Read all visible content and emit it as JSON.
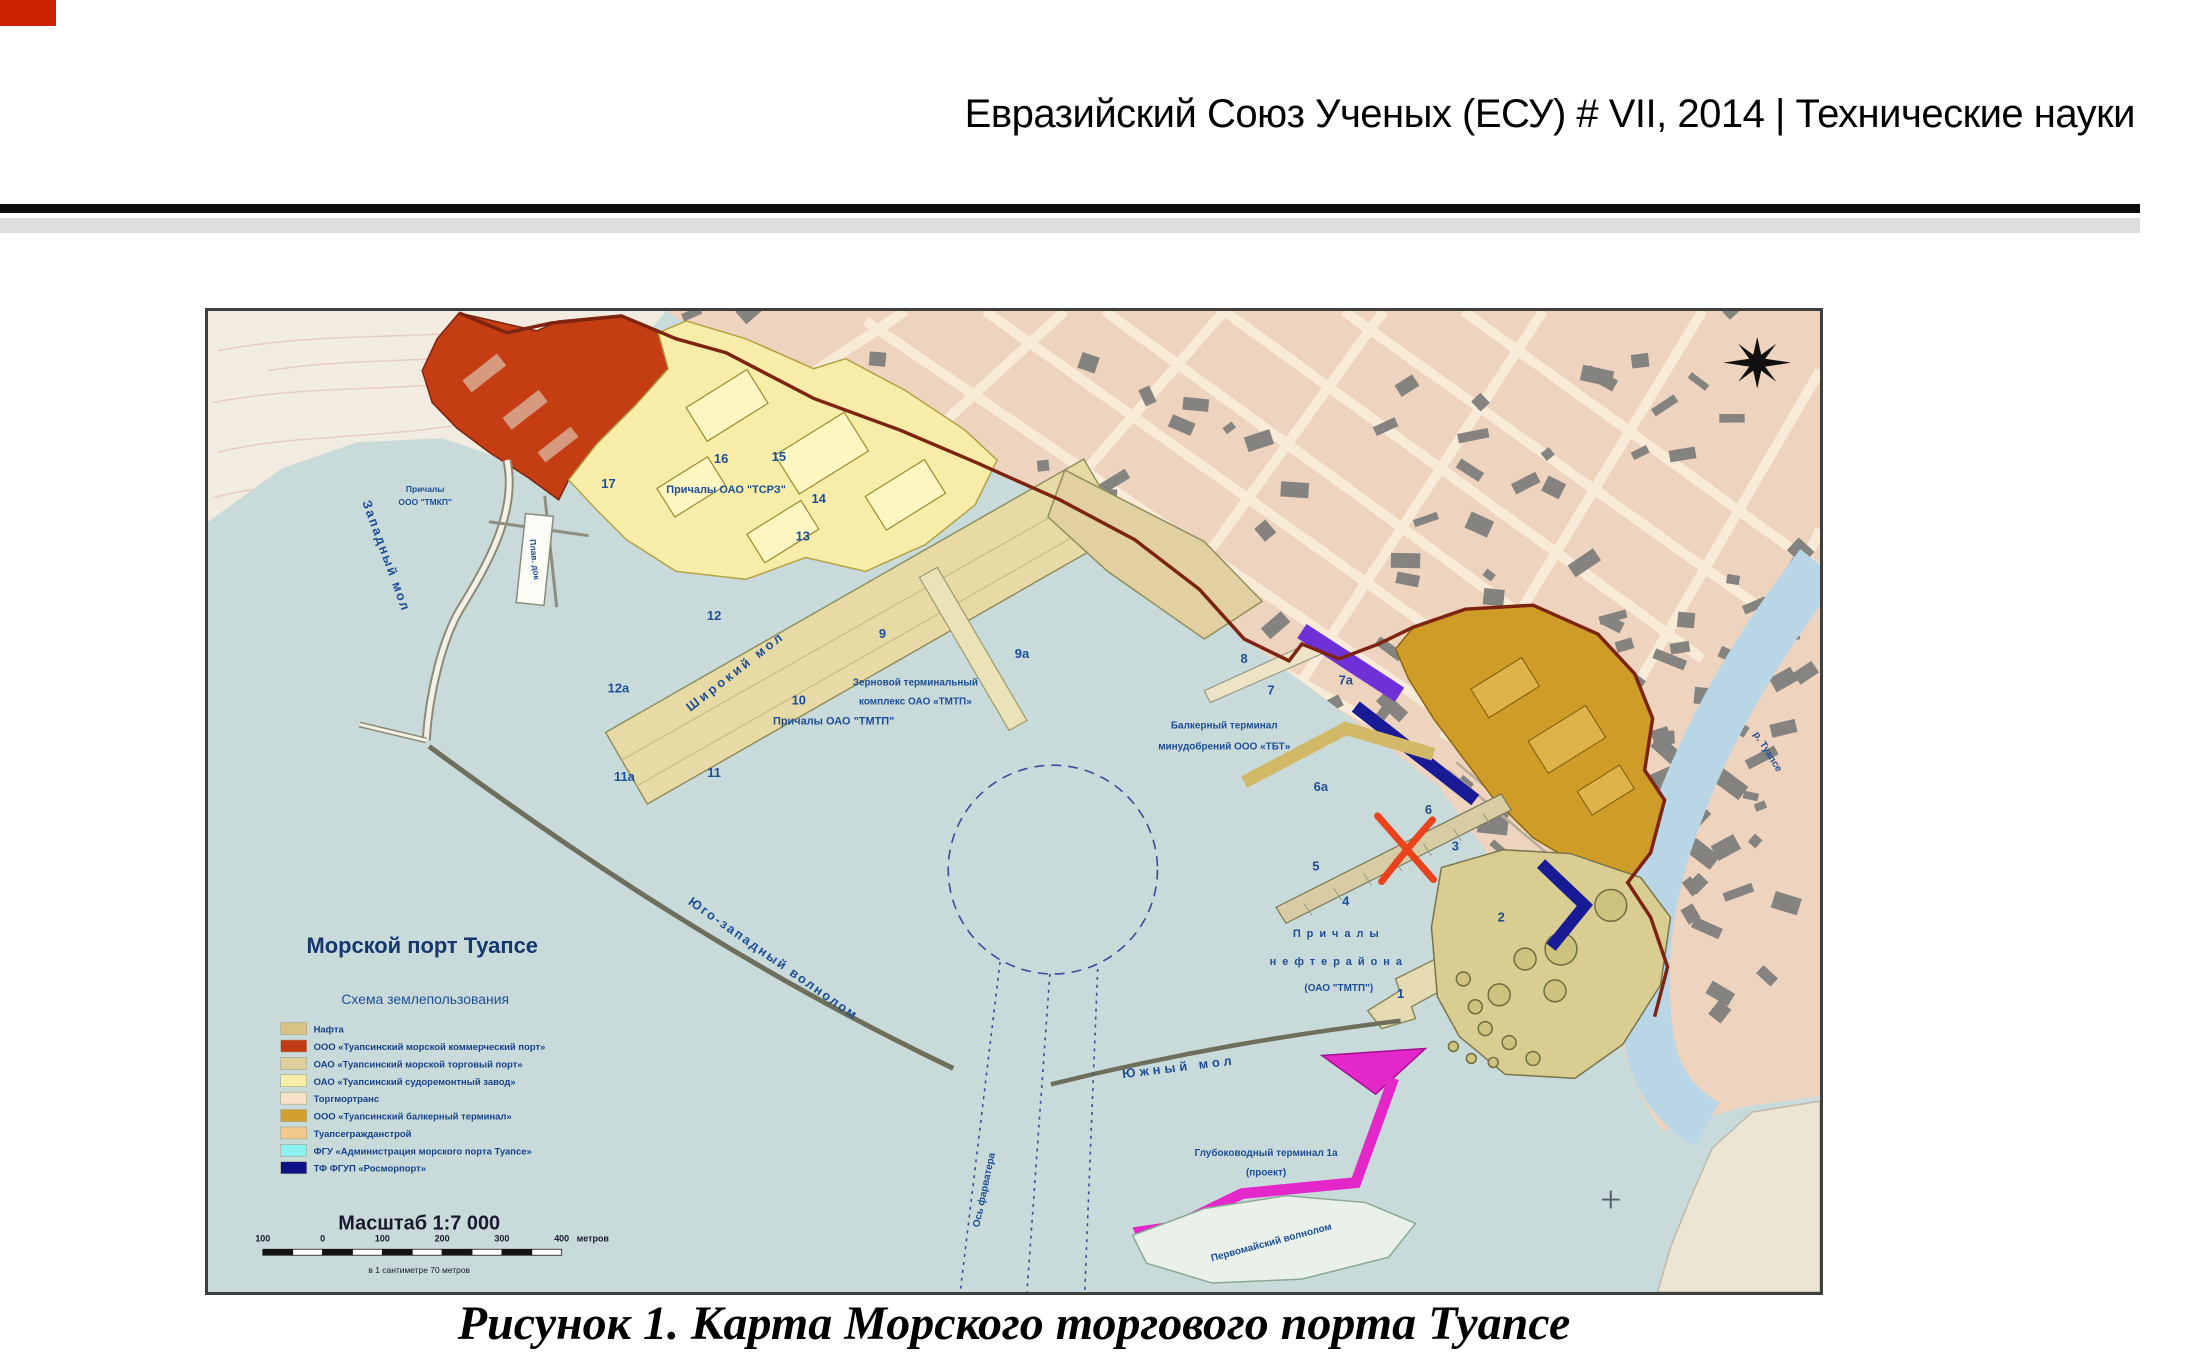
{
  "page": {
    "header": "Евразийский Союз Ученых (ЕСУ) # VII, 2014 | Технические науки",
    "caption": "Рисунок 1. Карта Морского торгового порта Туапсе"
  },
  "map": {
    "title": "Морской порт Туапсе",
    "subtitle": "Схема землепользования",
    "legend": [
      {
        "label": "Нафта",
        "color": "#d9c286"
      },
      {
        "label": "ООО «Туапсинский морской коммерческий порт»",
        "color": "#c23a14"
      },
      {
        "label": "ОАО «Туапсинский морской торговый порт»",
        "color": "#ddd09e"
      },
      {
        "label": "ОАО «Туапсинский судоремонтный завод»",
        "color": "#f8eea9"
      },
      {
        "label": "Торгмортранс",
        "color": "#f6e3c9"
      },
      {
        "label": "ООО «Туапсинский балкерный терминал»",
        "color": "#d3a02e"
      },
      {
        "label": "Туапсегражданстрой",
        "color": "#f3c98e"
      },
      {
        "label": "ФГУ «Администрация морского порта Туапсе»",
        "color": "#8af0f2"
      },
      {
        "label": "ТФ ФГУП «Росморпорт»",
        "color": "#0e1286"
      }
    ],
    "scale": {
      "title": "Масштаб 1:7 000",
      "ticks": [
        "100",
        "0",
        "100",
        "200",
        "300",
        "400"
      ],
      "unit": "метров",
      "note": "в 1 сантиметре 70 метров"
    },
    "labels": {
      "zapadny_mol": "Западный мол",
      "shiroky_mol": "Широкий мол",
      "yugo_zapadny_volnolom": "Юго-западный волнолом",
      "yuzhny_mol": "Южный мол",
      "pervomaysky_volnolom": "Первомайский волнолом",
      "os_farvatera": "Ось фарватера",
      "reka_tuapse": "р. Туапсе",
      "plav_dok": "Плав. док",
      "prichaly_tmkp_1": "Причалы",
      "prichaly_tmkp_2": "ООО \"ТМКП\"",
      "prichaly_tsrz": "Причалы ОАО \"ТСРЗ\"",
      "prichaly_tmtp": "Причалы ОАО \"ТМТП\"",
      "zernovoy_line1": "Зерновой терминальный",
      "zernovoy_line2": "комплекс ОАО «ТМТП»",
      "balker_line1": "Балкерный терминал",
      "balker_line2": "минудобрений ООО «ТБТ»",
      "neft_line1": "Причалы",
      "neft_line2": "нефтерайона",
      "neft_line3": "(ОАО \"ТМТП\")",
      "glub_line1": "Глубоководный терминал 1а",
      "glub_line2": "(проект)"
    },
    "berths": [
      "17",
      "16",
      "15",
      "14",
      "13",
      "12",
      "12а",
      "11а",
      "11",
      "10",
      "9",
      "9а",
      "8",
      "7",
      "7а",
      "6а",
      "6",
      "5",
      "4",
      "3",
      "2",
      "1"
    ]
  }
}
